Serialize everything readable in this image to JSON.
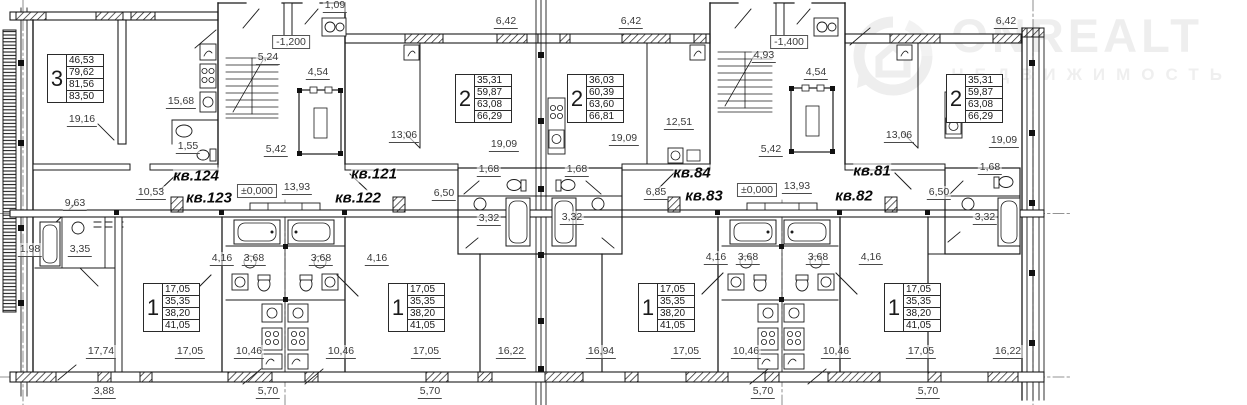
{
  "watermark": {
    "brand": "ONREALT",
    "subtitle": "НЕДВИЖИМОСТЬ",
    "color": "#eeeeee"
  },
  "plan": {
    "area_tables": [
      {
        "room": "3",
        "values": [
          "46,53",
          "79,62",
          "81,56",
          "83,50"
        ],
        "x": 47,
        "y": 54
      },
      {
        "room": "2",
        "values": [
          "35,31",
          "59,87",
          "63,08",
          "66,29"
        ],
        "x": 455,
        "y": 74
      },
      {
        "room": "2",
        "values": [
          "36,03",
          "60,39",
          "63,60",
          "66,81"
        ],
        "x": 567,
        "y": 74
      },
      {
        "room": "2",
        "values": [
          "35,31",
          "59,87",
          "63,08",
          "66,29"
        ],
        "x": 946,
        "y": 74
      },
      {
        "room": "1",
        "values": [
          "17,05",
          "35,35",
          "38,20",
          "41,05"
        ],
        "x": 143,
        "y": 283
      },
      {
        "room": "1",
        "values": [
          "17,05",
          "35,35",
          "38,20",
          "41,05"
        ],
        "x": 388,
        "y": 283
      },
      {
        "room": "1",
        "values": [
          "17,05",
          "35,35",
          "38,20",
          "41,05"
        ],
        "x": 638,
        "y": 283
      },
      {
        "room": "1",
        "values": [
          "17,05",
          "35,35",
          "38,20",
          "41,05"
        ],
        "x": 884,
        "y": 283
      }
    ],
    "labels": [
      {
        "t": "1,09",
        "x": 335,
        "y": 6,
        "k": "dim"
      },
      {
        "t": "6,42",
        "x": 506,
        "y": 22,
        "k": "dim"
      },
      {
        "t": "6,42",
        "x": 631,
        "y": 22,
        "k": "dim"
      },
      {
        "t": "6,42",
        "x": 1006,
        "y": 22,
        "k": "dim"
      },
      {
        "t": "19,16",
        "x": 82,
        "y": 120,
        "k": "dim"
      },
      {
        "t": "15,68",
        "x": 181,
        "y": 102,
        "k": "dim"
      },
      {
        "t": "1,55",
        "x": 188,
        "y": 147,
        "k": "dim"
      },
      {
        "t": "5,24",
        "x": 268,
        "y": 58,
        "k": "dim"
      },
      {
        "t": "-1,200",
        "x": 291,
        "y": 42,
        "k": "level"
      },
      {
        "t": "4,54",
        "x": 318,
        "y": 73,
        "k": "dim"
      },
      {
        "t": "5,42",
        "x": 276,
        "y": 150,
        "k": "dim"
      },
      {
        "t": "13,06",
        "x": 404,
        "y": 136,
        "k": "dim"
      },
      {
        "t": "19,09",
        "x": 504,
        "y": 145,
        "k": "dim"
      },
      {
        "t": "19,09",
        "x": 624,
        "y": 139,
        "k": "dim"
      },
      {
        "t": "12,51",
        "x": 679,
        "y": 123,
        "k": "dim"
      },
      {
        "t": "4,93",
        "x": 764,
        "y": 56,
        "k": "dim"
      },
      {
        "t": "-1,400",
        "x": 789,
        "y": 42,
        "k": "level"
      },
      {
        "t": "4,54",
        "x": 816,
        "y": 73,
        "k": "dim"
      },
      {
        "t": "5,42",
        "x": 771,
        "y": 150,
        "k": "dim"
      },
      {
        "t": "13,06",
        "x": 899,
        "y": 136,
        "k": "dim"
      },
      {
        "t": "19,09",
        "x": 1004,
        "y": 141,
        "k": "dim"
      },
      {
        "t": "кв.124",
        "x": 196,
        "y": 176,
        "k": "apt"
      },
      {
        "t": "кв.123",
        "x": 209,
        "y": 198,
        "k": "apt"
      },
      {
        "t": "кв.121",
        "x": 374,
        "y": 174,
        "k": "apt"
      },
      {
        "t": "кв.122",
        "x": 358,
        "y": 198,
        "k": "apt"
      },
      {
        "t": "кв.84",
        "x": 692,
        "y": 173,
        "k": "apt"
      },
      {
        "t": "кв.83",
        "x": 704,
        "y": 196,
        "k": "apt"
      },
      {
        "t": "кв.81",
        "x": 872,
        "y": 171,
        "k": "apt"
      },
      {
        "t": "кв.82",
        "x": 854,
        "y": 196,
        "k": "apt"
      },
      {
        "t": "±0,000",
        "x": 257,
        "y": 191,
        "k": "level"
      },
      {
        "t": "13,93",
        "x": 297,
        "y": 188,
        "k": "dim"
      },
      {
        "t": "±0,000",
        "x": 757,
        "y": 190,
        "k": "level"
      },
      {
        "t": "13,93",
        "x": 797,
        "y": 187,
        "k": "dim"
      },
      {
        "t": "10,53",
        "x": 151,
        "y": 193,
        "k": "dim"
      },
      {
        "t": "6,50",
        "x": 444,
        "y": 194,
        "k": "dim"
      },
      {
        "t": "6,85",
        "x": 656,
        "y": 193,
        "k": "dim"
      },
      {
        "t": "6,50",
        "x": 939,
        "y": 193,
        "k": "dim"
      },
      {
        "t": "1,68",
        "x": 489,
        "y": 170,
        "k": "dim"
      },
      {
        "t": "1,68",
        "x": 577,
        "y": 170,
        "k": "dim"
      },
      {
        "t": "1,68",
        "x": 990,
        "y": 168,
        "k": "dim"
      },
      {
        "t": "3,32",
        "x": 489,
        "y": 219,
        "k": "dim"
      },
      {
        "t": "3,32",
        "x": 572,
        "y": 218,
        "k": "dim"
      },
      {
        "t": "3,32",
        "x": 985,
        "y": 218,
        "k": "dim"
      },
      {
        "t": "9,63",
        "x": 75,
        "y": 204,
        "k": "dim"
      },
      {
        "t": "1,98",
        "x": 30,
        "y": 250,
        "k": "dim"
      },
      {
        "t": "3,35",
        "x": 80,
        "y": 250,
        "k": "dim"
      },
      {
        "t": "4,16",
        "x": 222,
        "y": 259,
        "k": "dim"
      },
      {
        "t": "3,68",
        "x": 254,
        "y": 259,
        "k": "dim"
      },
      {
        "t": "3,68",
        "x": 321,
        "y": 259,
        "k": "dim"
      },
      {
        "t": "4,16",
        "x": 377,
        "y": 259,
        "k": "dim"
      },
      {
        "t": "4,16",
        "x": 716,
        "y": 258,
        "k": "dim"
      },
      {
        "t": "3,68",
        "x": 748,
        "y": 258,
        "k": "dim"
      },
      {
        "t": "3,68",
        "x": 818,
        "y": 258,
        "k": "dim"
      },
      {
        "t": "4,16",
        "x": 871,
        "y": 258,
        "k": "dim"
      },
      {
        "t": "17,74",
        "x": 101,
        "y": 352,
        "k": "dim"
      },
      {
        "t": "17,05",
        "x": 190,
        "y": 352,
        "k": "dim"
      },
      {
        "t": "10,46",
        "x": 249,
        "y": 352,
        "k": "dim"
      },
      {
        "t": "10,46",
        "x": 341,
        "y": 352,
        "k": "dim"
      },
      {
        "t": "17,05",
        "x": 426,
        "y": 352,
        "k": "dim"
      },
      {
        "t": "16,22",
        "x": 511,
        "y": 352,
        "k": "dim"
      },
      {
        "t": "16,94",
        "x": 601,
        "y": 352,
        "k": "dim"
      },
      {
        "t": "17,05",
        "x": 686,
        "y": 352,
        "k": "dim"
      },
      {
        "t": "10,46",
        "x": 746,
        "y": 352,
        "k": "dim"
      },
      {
        "t": "10,46",
        "x": 836,
        "y": 352,
        "k": "dim"
      },
      {
        "t": "17,05",
        "x": 921,
        "y": 352,
        "k": "dim"
      },
      {
        "t": "16,22",
        "x": 1008,
        "y": 352,
        "k": "dim"
      },
      {
        "t": "3,88",
        "x": 104,
        "y": 392,
        "k": "dim"
      },
      {
        "t": "5,70",
        "x": 268,
        "y": 392,
        "k": "dim"
      },
      {
        "t": "5,70",
        "x": 430,
        "y": 392,
        "k": "dim"
      },
      {
        "t": "5,70",
        "x": 763,
        "y": 392,
        "k": "dim"
      },
      {
        "t": "5,70",
        "x": 928,
        "y": 392,
        "k": "dim"
      }
    ]
  }
}
